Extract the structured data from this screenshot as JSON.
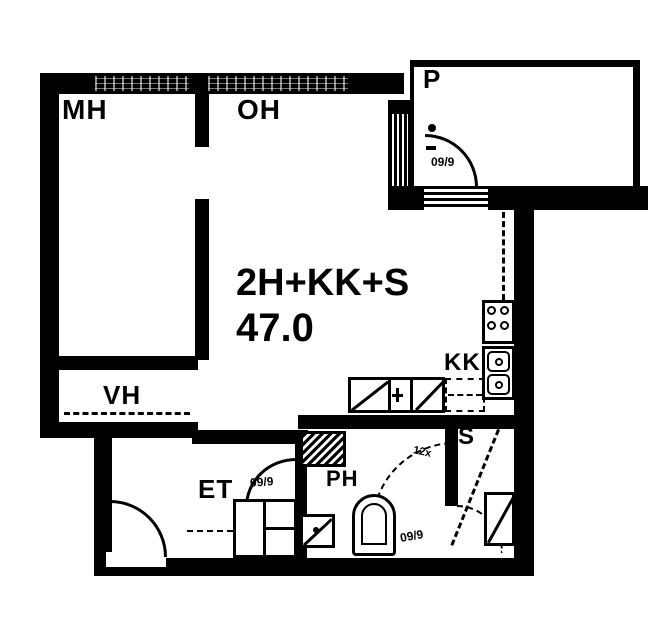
{
  "apartment": {
    "type_label": "2H+KK+S",
    "area_label": "47.0",
    "rooms": {
      "mh": "MH",
      "oh": "OH",
      "balcony": "P",
      "vh": "VH",
      "et": "ET",
      "ph": "PH",
      "kk": "KK",
      "sauna": "S"
    },
    "door_marks": {
      "balcony_door": "09/9",
      "ph_door": "09/9",
      "wc_area": "09/9",
      "misc": "12x"
    },
    "colors": {
      "ink": "#000000",
      "paper": "#ffffff",
      "window_gray": "#777777"
    }
  }
}
